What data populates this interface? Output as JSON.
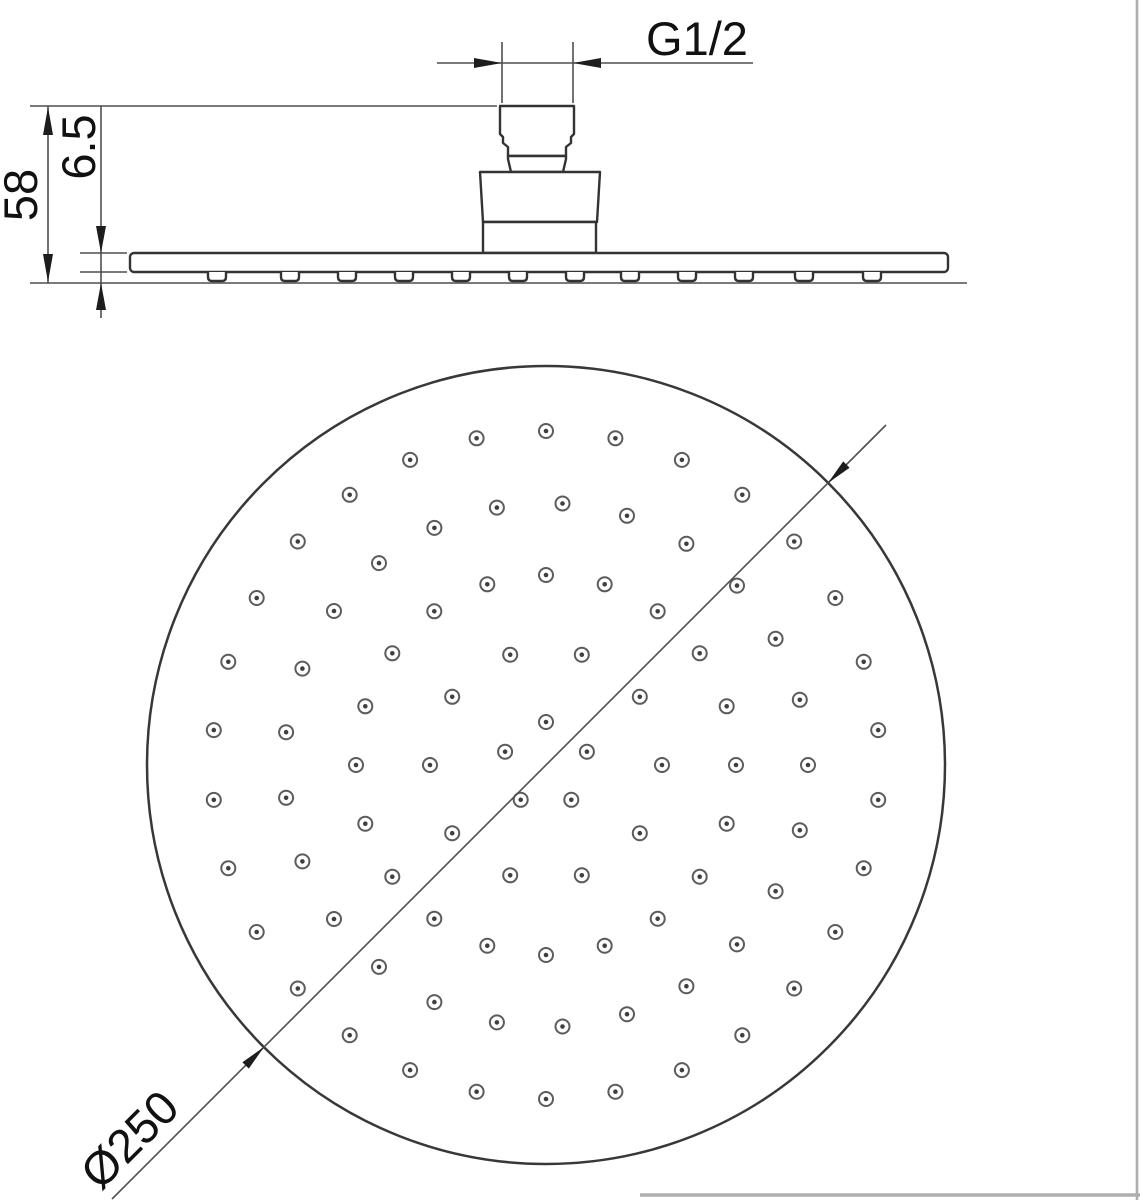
{
  "drawing": {
    "kind": "round rain shower head — dimensioned technical drawing",
    "views": [
      "side elevation",
      "spray face (bottom) view"
    ]
  },
  "side_view": {
    "thread_label": "G1/2",
    "overall_height_label": "58",
    "edge_thickness_label": "6.5",
    "nozzle_positions_px": [
      217,
      290,
      347,
      404,
      461,
      518,
      575,
      630,
      687,
      744,
      804,
      872
    ]
  },
  "bottom_view": {
    "diameter_label": "Ø250",
    "face_circle": {
      "cx": 546,
      "cy": 765,
      "r": 399
    },
    "hole_outer_radius": 7,
    "hole_dot_radius": 2.3,
    "hole_rings": [
      {
        "radius": 43,
        "count": 5,
        "offset_deg": 90
      },
      {
        "radius": 116,
        "count": 10,
        "offset_deg": 0
      },
      {
        "radius": 190,
        "count": 20,
        "offset_deg": 0
      },
      {
        "radius": 262,
        "count": 25,
        "offset_deg": 0
      },
      {
        "radius": 334,
        "count": 30,
        "offset_deg": 6
      }
    ]
  },
  "colors": {
    "geometry": "#333333",
    "dimension": "#4f4f4f",
    "text": "#111111",
    "background": "#ffffff",
    "page_edge": "#aeaeae"
  }
}
